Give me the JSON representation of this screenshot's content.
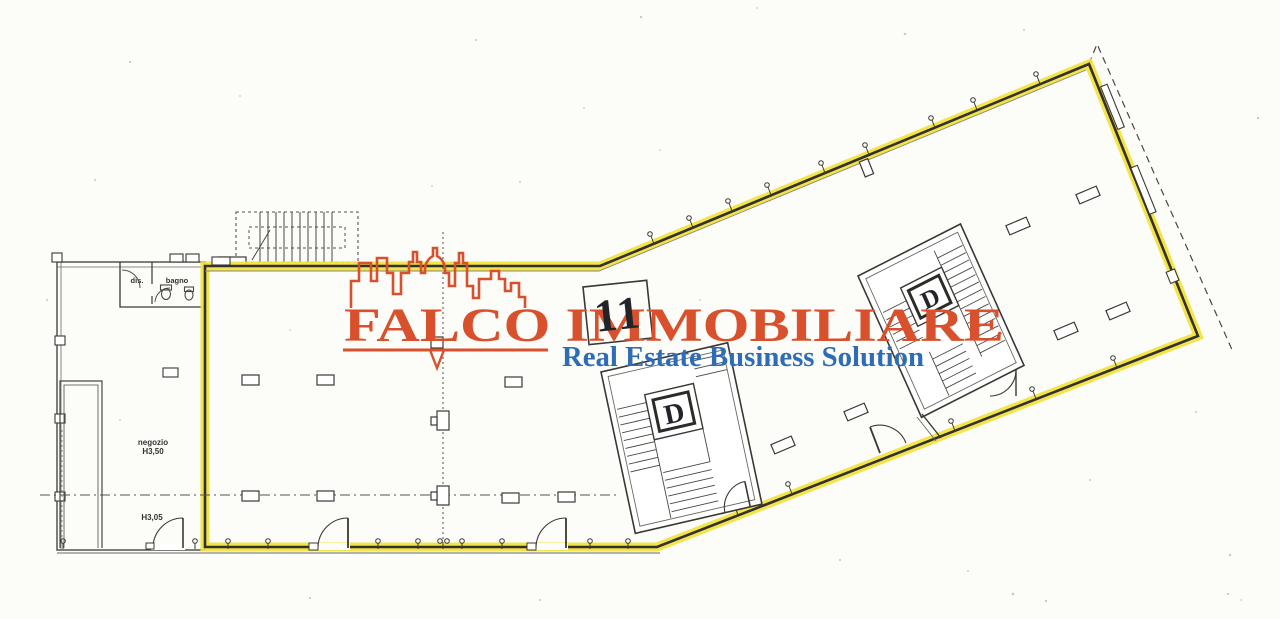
{
  "document_type": "scanned-floor-plan",
  "watermark": {
    "brand": "FALCO IMMOBILIARE",
    "tagline": "Real Estate Business Solution",
    "brand_color": "#d8512c",
    "tagline_color": "#2e6cb5",
    "logo_icon": "city-skyline-icon"
  },
  "plan": {
    "unit_number": "11",
    "elevator_1_label": "D",
    "elevator_2_label": "D",
    "highlight_color": "#f2e239",
    "room_labels": {
      "dis": "dis.",
      "bagno": "bagno",
      "negozio_name": "negozio",
      "negozio_height": "H3,50",
      "ceiling_height": "H3,05"
    }
  }
}
